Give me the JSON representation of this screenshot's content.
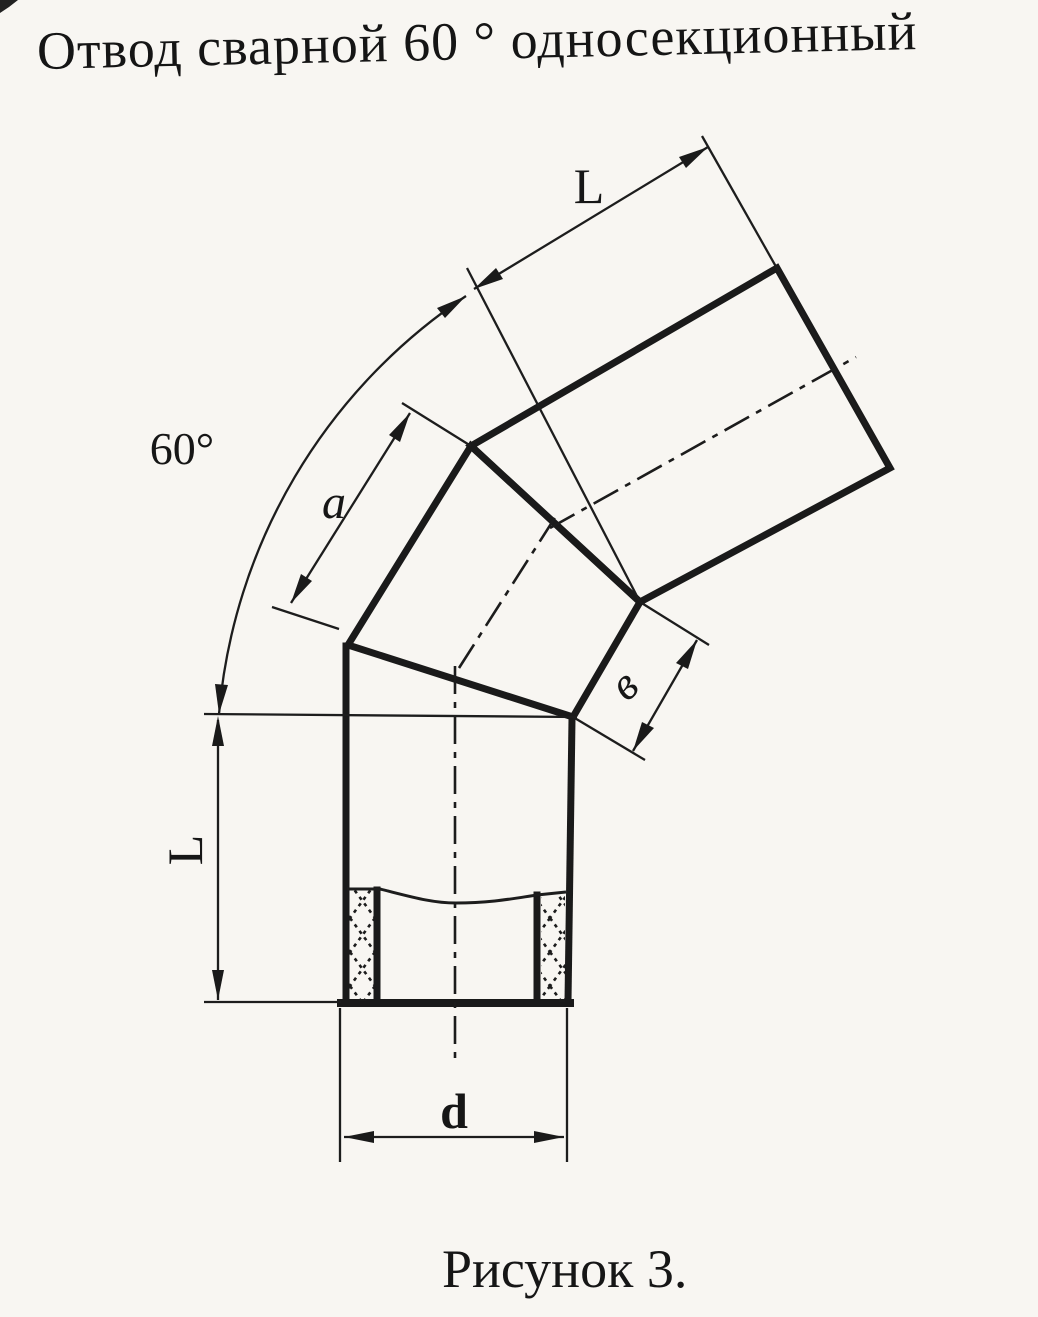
{
  "page": {
    "title": "Отвод сварной 60 ° односекционный",
    "caption": "Рисунок 3.",
    "paper_color": "#f8f6f2",
    "ink_color": "#1a1a1a"
  },
  "figure": {
    "angle_label": "60°",
    "labels": {
      "upper_length": "L",
      "outer_segment": "a",
      "inner_segment": "в",
      "lower_length": "L",
      "diameter": "d"
    }
  }
}
